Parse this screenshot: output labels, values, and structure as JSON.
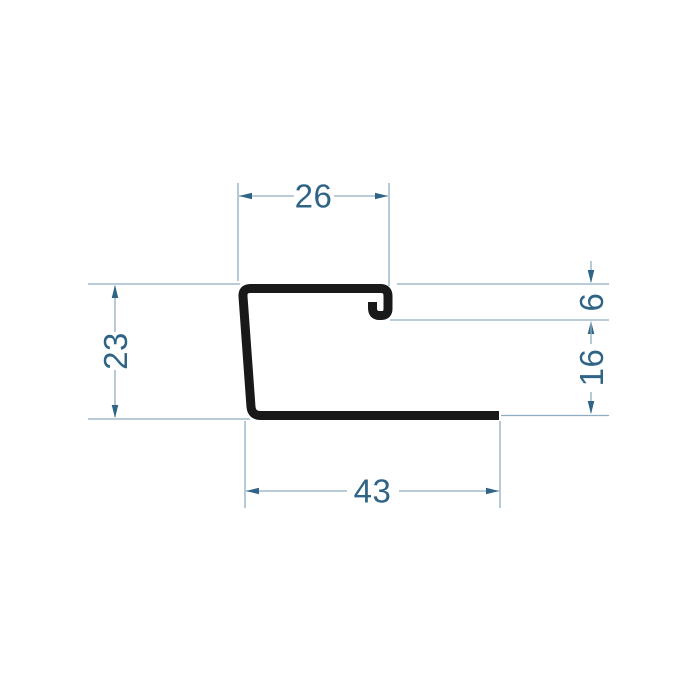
{
  "page": {
    "background_color": "#ffffff"
  },
  "drawing": {
    "kind": "profile-cross-section",
    "profile_color": "#191919",
    "dimension_line_color": "#8fadc0",
    "dimension_text_color": "#2f6486",
    "dimensions": {
      "top_width": "26",
      "lip_height": "6",
      "lip_to_base_height": "16",
      "left_height": "23",
      "base_width": "43"
    }
  }
}
